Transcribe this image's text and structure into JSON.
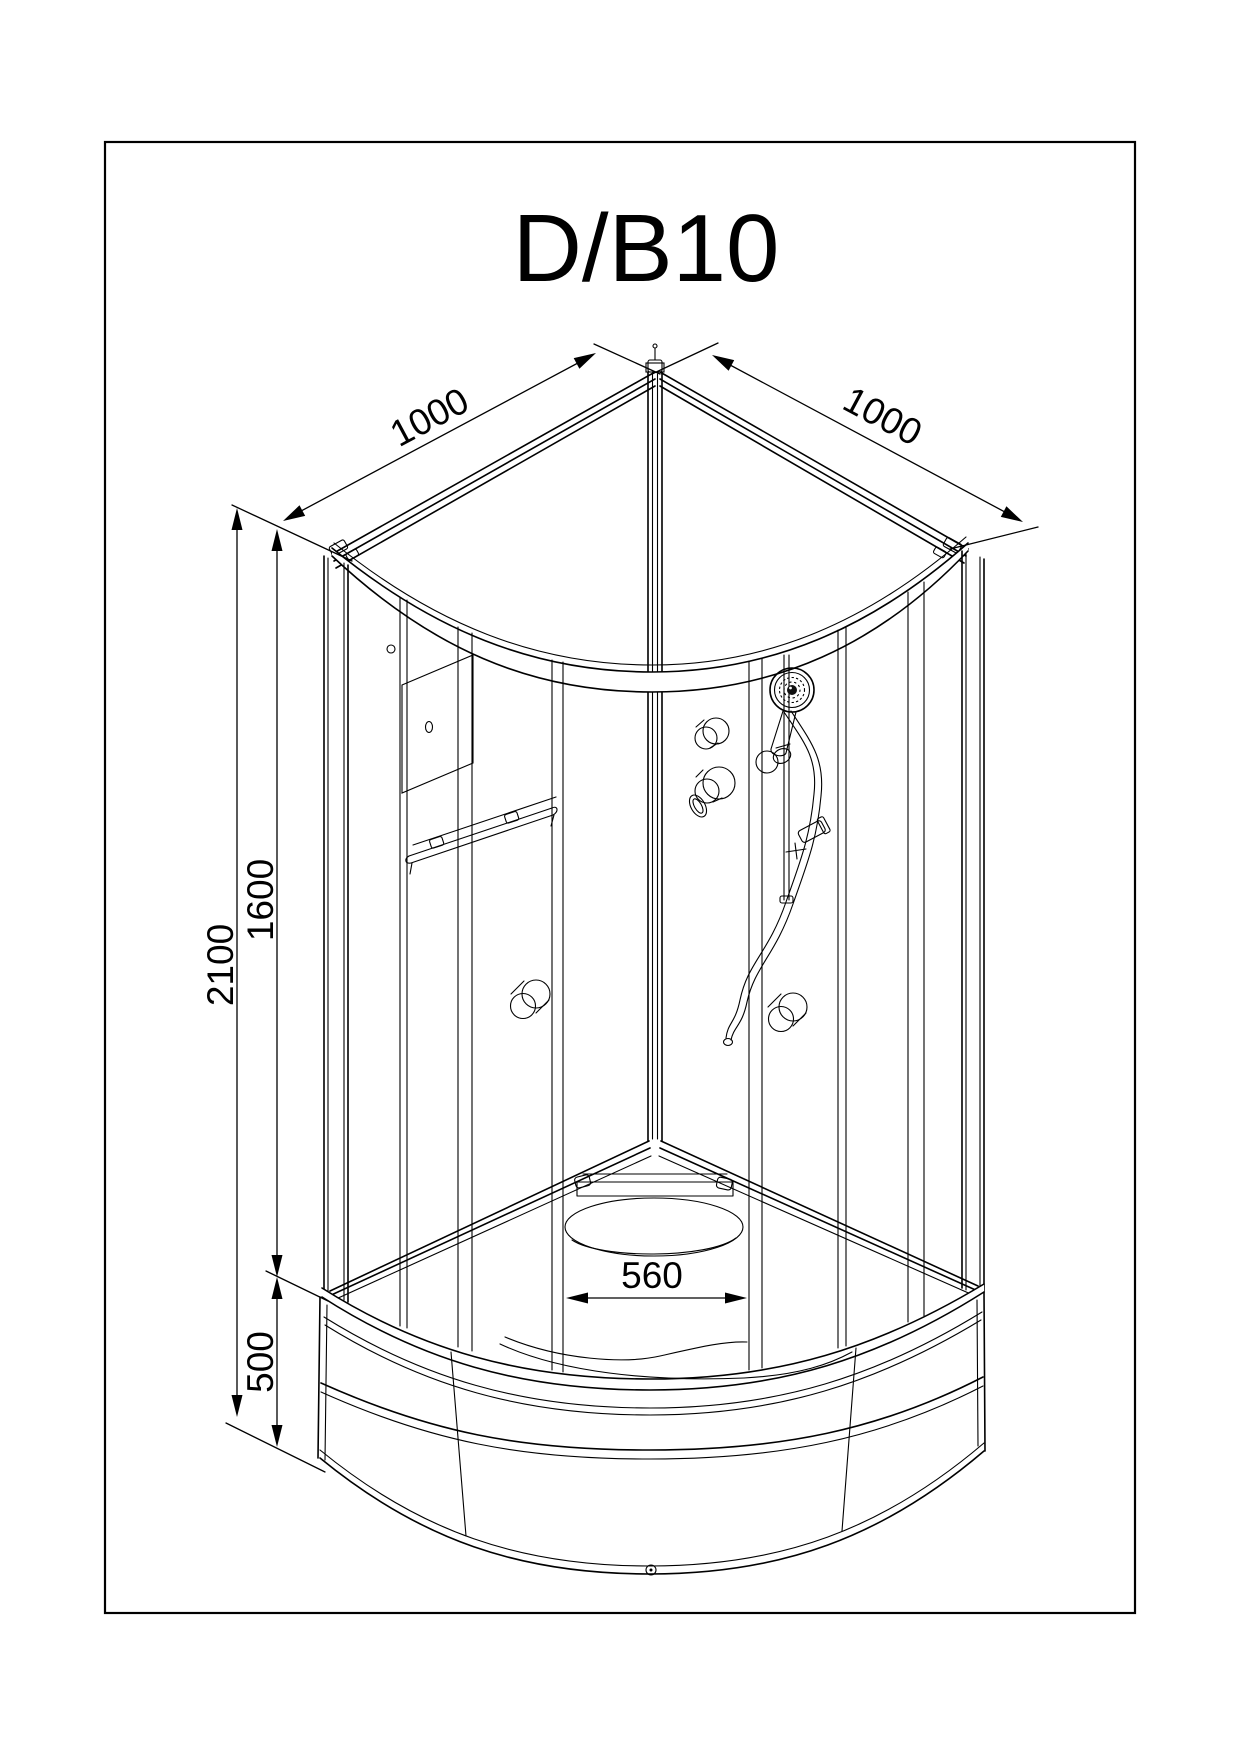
{
  "page": {
    "background_color": "#ffffff",
    "line_color": "#000000"
  },
  "drawing": {
    "title": "D/B10",
    "dimensions": {
      "top_left_width": "1000",
      "top_right_width": "1000",
      "total_height": "2100",
      "cabin_glass_height": "1600",
      "tray_height": "500",
      "tray_inner_width": "560"
    }
  }
}
